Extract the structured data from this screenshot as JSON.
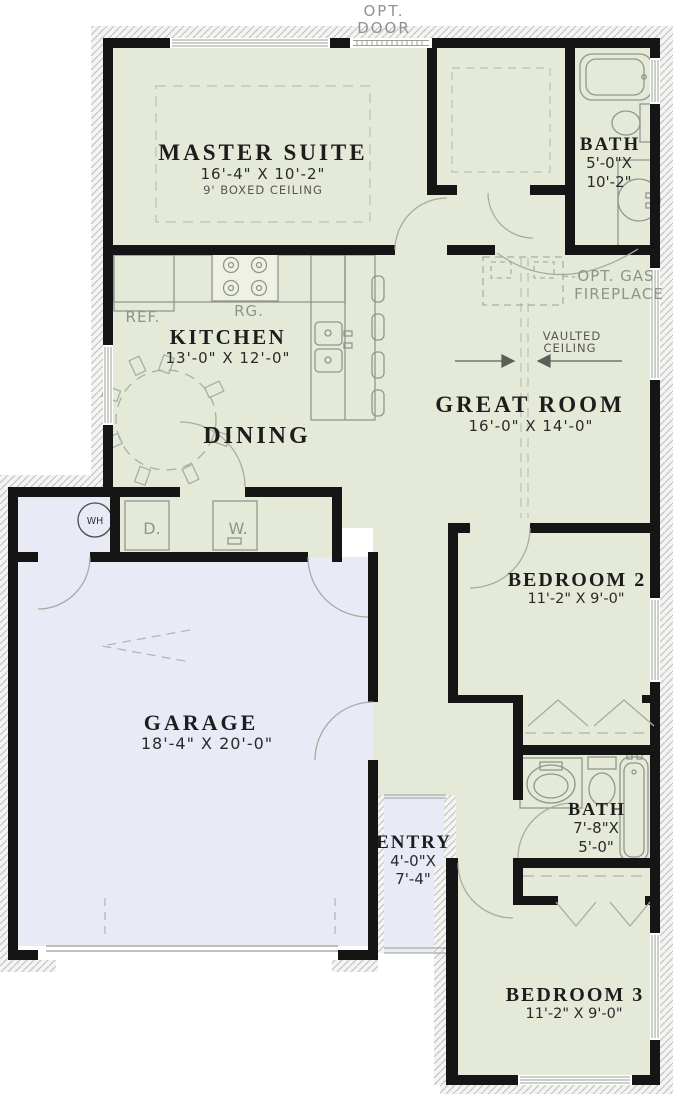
{
  "plan": {
    "colors": {
      "room_green": "#e5ead8",
      "garage_blue": "#e8ebf6",
      "wall_black": "#151515",
      "fixture_gray": "#9aa096",
      "annotation_gray": "#8d948b"
    },
    "annotations": {
      "opt_door_line1": "OPT.",
      "opt_door_line2": "DOOR",
      "ref": "REF.",
      "rg": "RG.",
      "opt_gas_line1": "OPT. GAS",
      "opt_gas_line2": "FIREPLACE",
      "vaulted_line1": "VAULTED",
      "vaulted_line2": "CEILING",
      "water_heater": "WH",
      "dryer": "D.",
      "washer": "W."
    },
    "rooms": {
      "master_suite": {
        "name": "MASTER SUITE",
        "dims": "16'-4\" X 10'-2\"",
        "note": "9' BOXED CEILING"
      },
      "bath1": {
        "name": "BATH",
        "dims_line1": "5'-0\"X",
        "dims_line2": "10'-2\""
      },
      "kitchen": {
        "name": "KITCHEN",
        "dims": "13'-0\" X 12'-0\""
      },
      "dining": {
        "name": "DINING"
      },
      "great_room": {
        "name": "GREAT ROOM",
        "dims": "16'-0\" X 14'-0\""
      },
      "garage": {
        "name": "GARAGE",
        "dims": "18'-4\" X 20'-0\""
      },
      "entry": {
        "name": "ENTRY",
        "dims_line1": "4'-0\"X",
        "dims_line2": "7'-4\""
      },
      "bedroom2": {
        "name": "BEDROOM 2",
        "dims": "11'-2\" X 9'-0\""
      },
      "bath2": {
        "name": "BATH",
        "dims_line1": "7'-8\"X",
        "dims_line2": "5'-0\""
      },
      "bedroom3": {
        "name": "BEDROOM 3",
        "dims": "11'-2\" X 9'-0\""
      }
    }
  }
}
